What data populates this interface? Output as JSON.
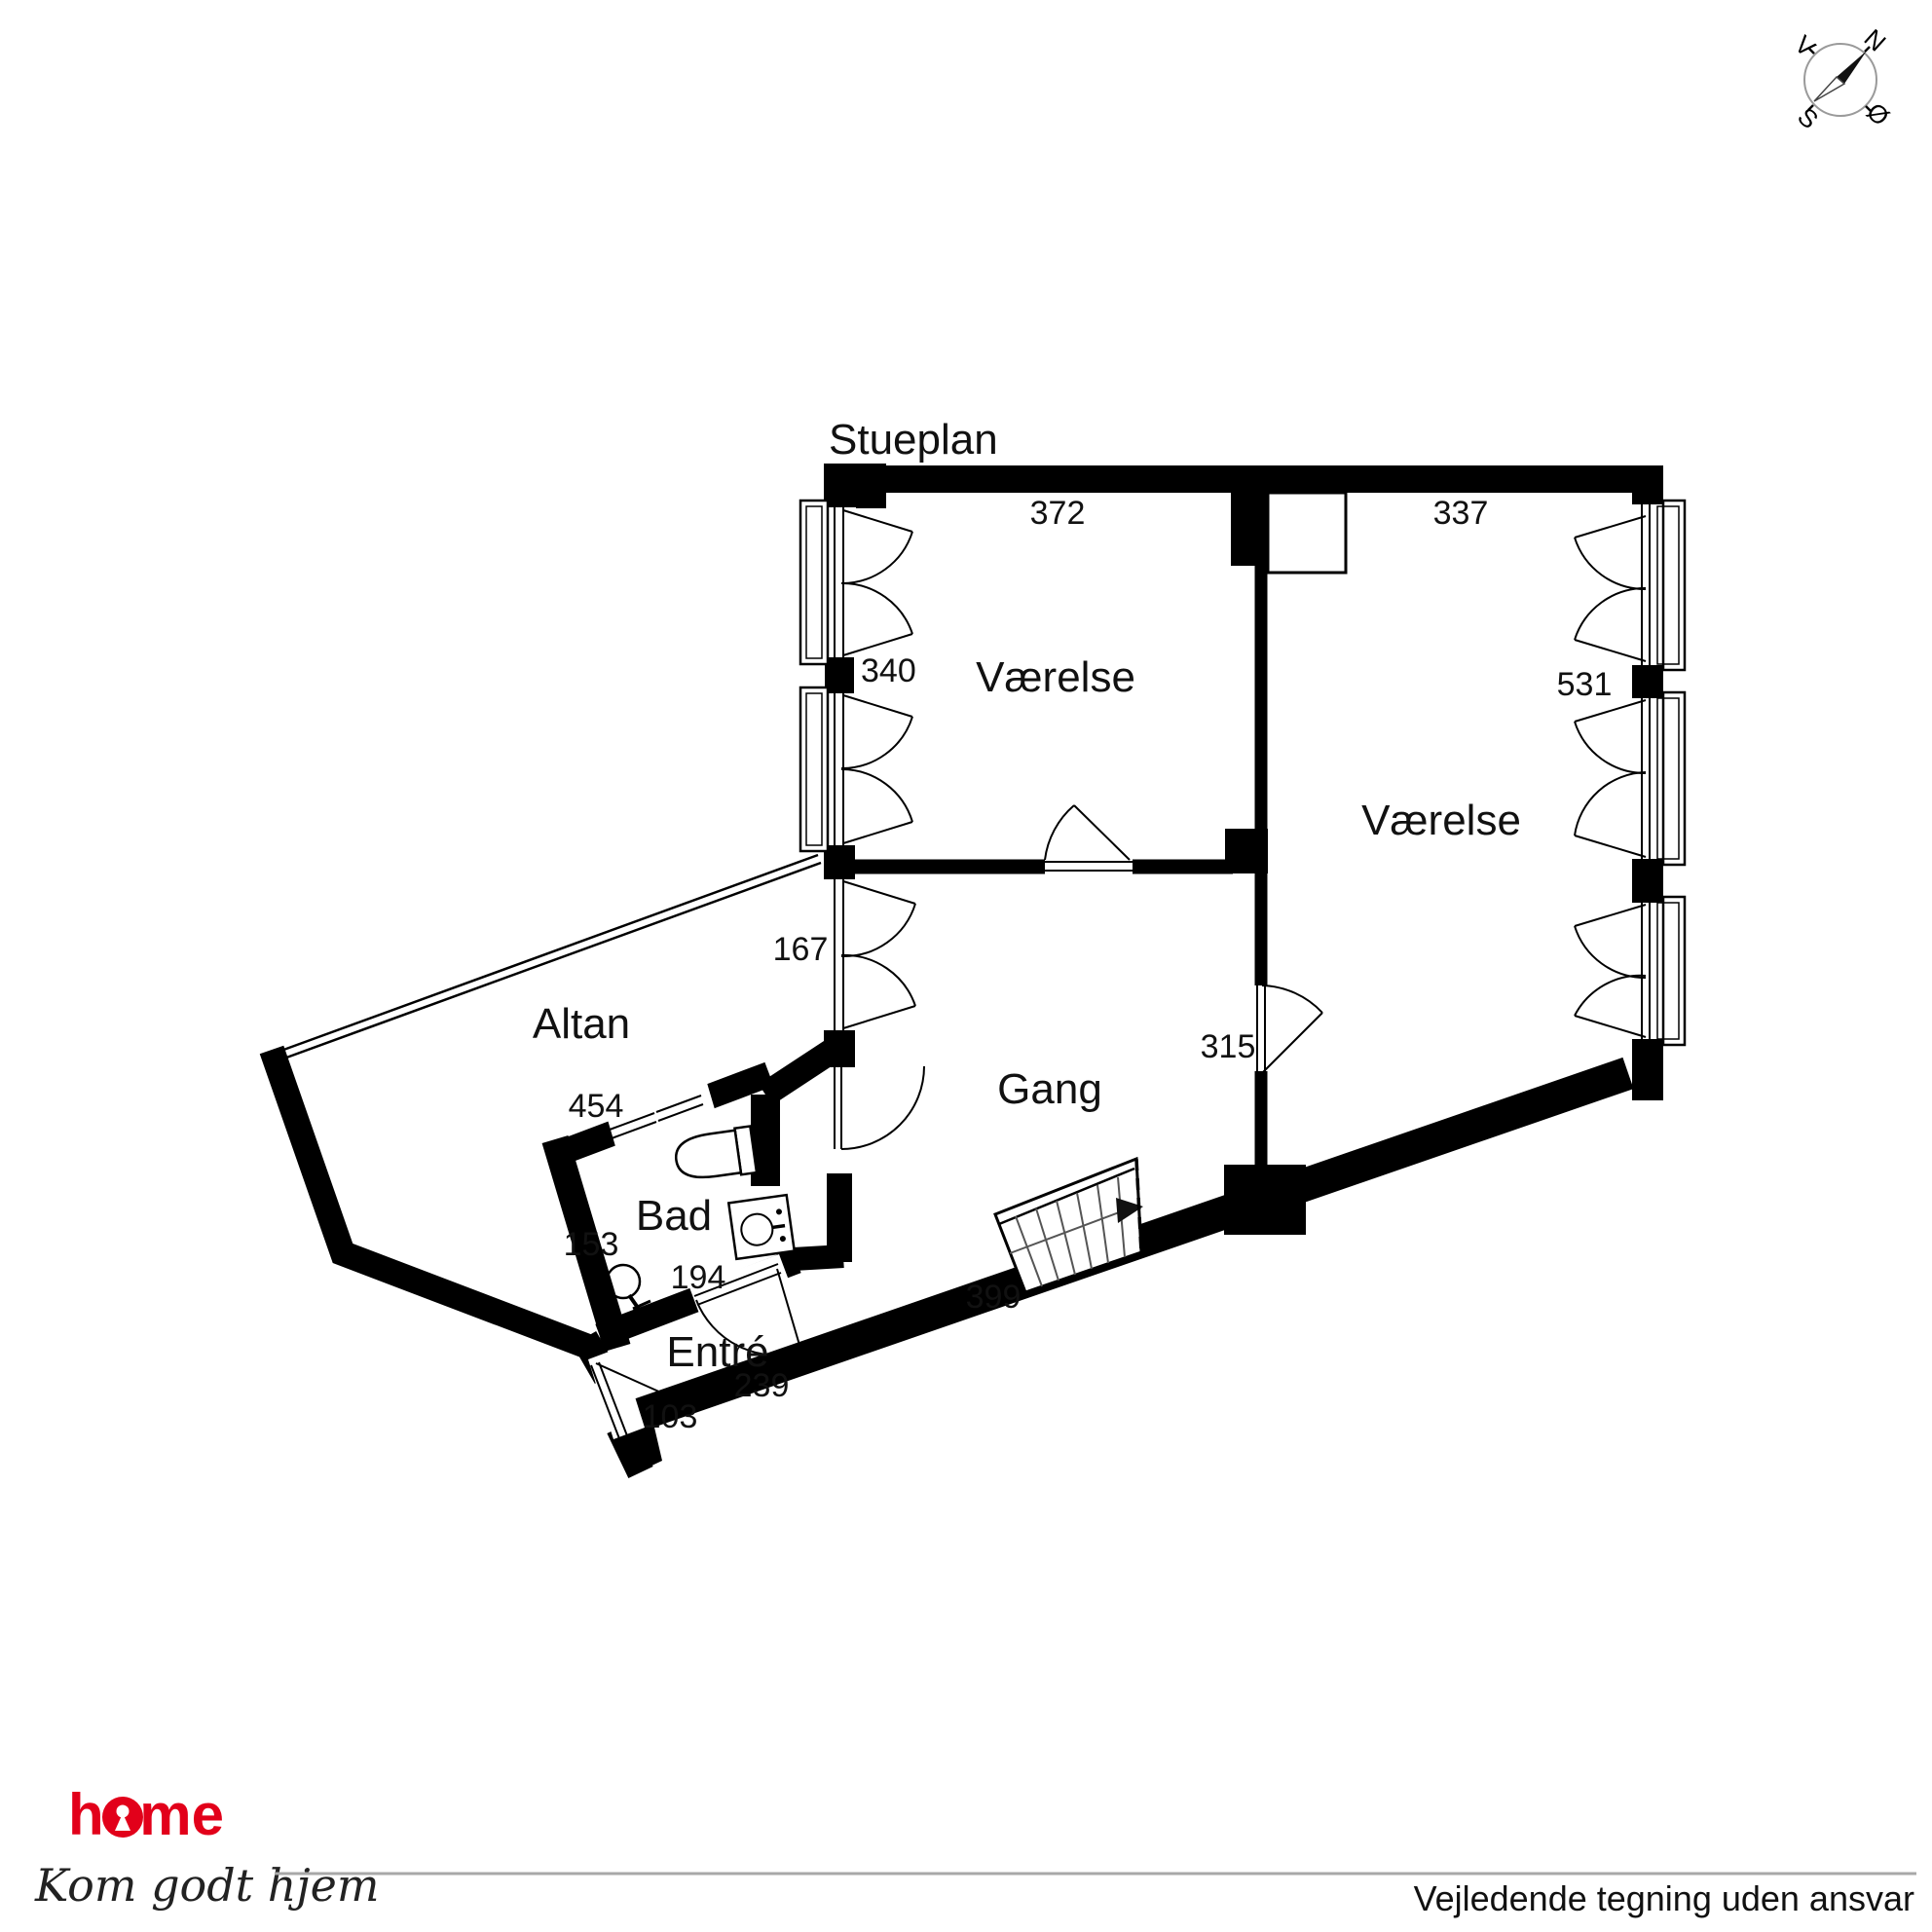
{
  "title": "Stueplan",
  "labels": {
    "room_left": "Værelse",
    "room_right": "Værelse",
    "gang": "Gang",
    "altan": "Altan",
    "bad": "Bad",
    "entre": "Entré"
  },
  "dims": {
    "d372": "372",
    "d337": "337",
    "d340": "340",
    "d531": "531",
    "d167": "167",
    "d315": "315",
    "d454": "454",
    "d153": "153",
    "d194": "194",
    "d399": "399",
    "d239": "239",
    "d103": "103"
  },
  "compass": {
    "north": "N",
    "south": "S",
    "east": "Ø",
    "west": "V"
  },
  "branding": {
    "logo": "home",
    "tagline": "Kom godt hjem",
    "color": "#e2001a"
  },
  "footer": {
    "disclaimer": "Vejledende tegning uden ansvar"
  }
}
